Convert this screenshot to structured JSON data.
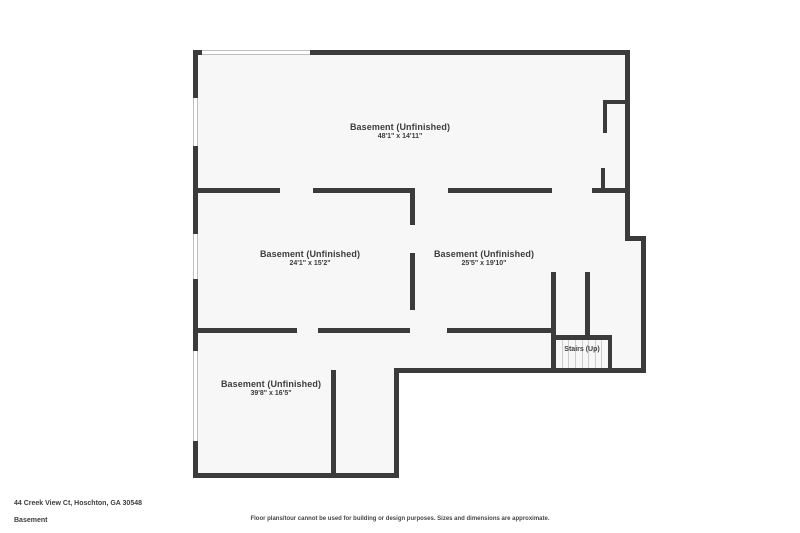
{
  "colors": {
    "wall": "#3b3b3b",
    "floor": "#f7f7f7",
    "window_fill": "#fdfdfd",
    "window_line": "#bfbfbf",
    "tread": "#cccccc",
    "ink": "#3d3d3d"
  },
  "rooms": [
    {
      "name": "Basement (Unfinished)",
      "dims": "48'1\" x 14'11\""
    },
    {
      "name": "Basement (Unfinished)",
      "dims": "24'1\" x 15'2\""
    },
    {
      "name": "Basement (Unfinished)",
      "dims": "25'5\" x 19'10\""
    },
    {
      "name": "Basement (Unfinished)",
      "dims": "39'8\" x 16'5\""
    }
  ],
  "stairs": {
    "label": "Stairs (Up)"
  },
  "footer": {
    "address": "44 Creek View Ct, Hoschton, GA 30548",
    "floor_name": "Basement",
    "disclaimer": "Floor plans/tour cannot be used for building or design purposes. Sizes and dimensions are approximate."
  }
}
